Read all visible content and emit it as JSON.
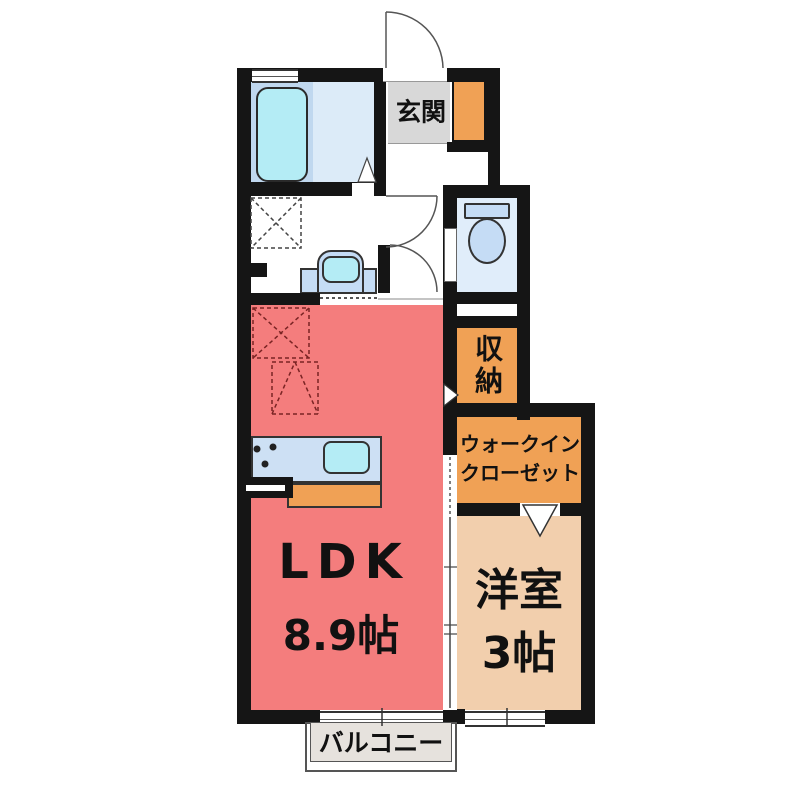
{
  "rooms": {
    "genkan": {
      "label": "玄関"
    },
    "storage": {
      "label": "収納"
    },
    "wic": {
      "line1": "ウォークイン",
      "line2": "クローゼット"
    },
    "ldk": {
      "label": "LDK",
      "size": "8.9帖"
    },
    "western": {
      "label": "洋室",
      "size": "3帖"
    },
    "balcony": {
      "label": "バルコニー"
    }
  },
  "fixtures": {
    "bathtub": "bathtub-icon",
    "toilet": "toilet-icon",
    "washbasin": "washbasin-icon",
    "kitchen_sink": "kitchen-sink-icon",
    "stove": "stove-burners-icon",
    "washer_space": "washing-machine-space",
    "fridge_space": "refrigerator-space"
  },
  "colors": {
    "wall": "#151515",
    "ldk": "#f47d7d",
    "accent_orange": "#f0a155",
    "western": "#f2cfad",
    "genkan_tile": "#d8d8d8",
    "bath_zone": "#c0d8ef",
    "bath_floor": "#dcebf8",
    "fixture_blue": "#c5dcf5",
    "water_cyan": "#b4ecf5",
    "toilet_floor": "#e0edfa",
    "counter_blue": "#cde0f4",
    "balcony_gray": "#e6e2dd"
  }
}
